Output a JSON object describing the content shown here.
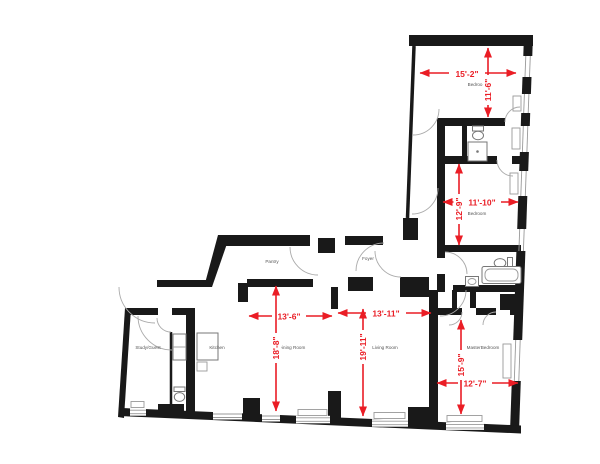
{
  "colors": {
    "background": "#ffffff",
    "wall": "#191919",
    "dimension_red": "#ea1d25",
    "room_label": "#555555",
    "fixture_outline": "#777777",
    "window_glass": "#999999"
  },
  "floor_plan": {
    "rooms": {
      "bedroom_top": "Bedroom",
      "bedroom_middle": "Bedroom",
      "master_bedroom": "MasterBedroom",
      "pantry": "Pantry",
      "foyer": "Foyer",
      "study_guest": "Study/Guest",
      "kitchen": "Kitchen",
      "dining_room": "Dining Room",
      "living_room": "Living Room"
    },
    "dimensions": {
      "bedroom_top_width": "15'-2\"",
      "bedroom_top_depth": "11'-6\"",
      "bedroom_middle_width": "11'-10\"",
      "bedroom_middle_depth": "12'-9\"",
      "dining_room_width": "13'-6\"",
      "dining_room_depth": "18'-8\"",
      "living_room_width": "13'-11\"",
      "living_room_depth": "19'-11\"",
      "master_bedroom_depth": "15'-9\"",
      "master_bedroom_width": "12'-7\""
    }
  }
}
